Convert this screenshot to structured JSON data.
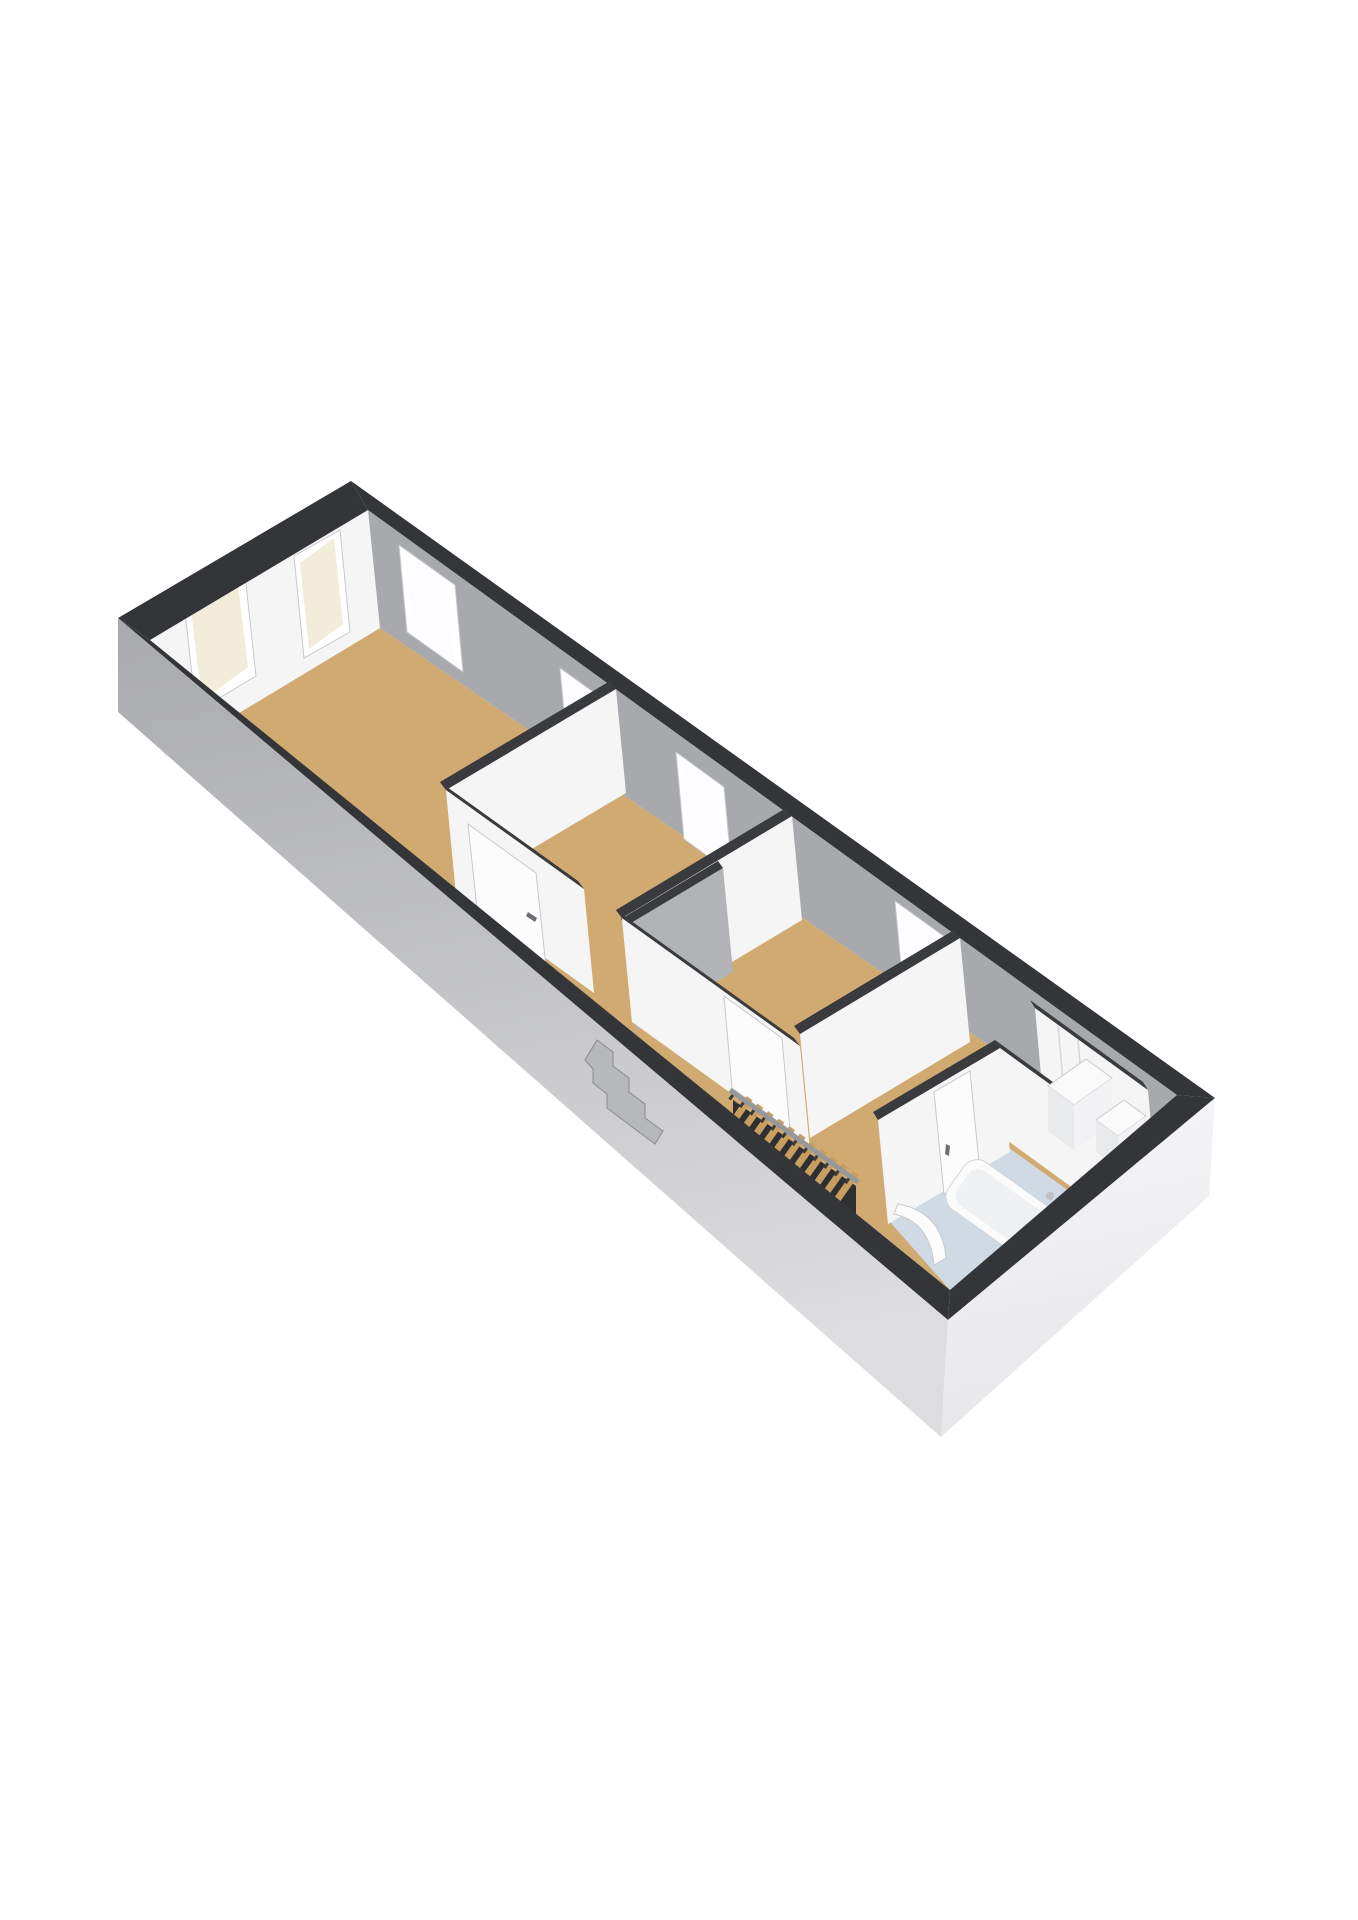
{
  "scene": {
    "kind": "3d-floor-plan",
    "view": "axonometric-top",
    "style": "floorplanner-render"
  },
  "inventory": {
    "rooms": [
      {
        "id": "bedroom-1",
        "floor": "wood",
        "windows": 4
      },
      {
        "id": "bedroom-2",
        "floor": "wood",
        "windows": 1
      },
      {
        "id": "bedroom-3",
        "floor": "wood",
        "windows": 1
      },
      {
        "id": "landing",
        "floor": "wood",
        "features": [
          "staircase",
          "balustrade"
        ]
      },
      {
        "id": "bathroom",
        "floor": "tile-blue",
        "features": [
          "bathtub",
          "door",
          "curved-screen"
        ]
      },
      {
        "id": "storage",
        "floor": "tile-light",
        "features": [
          "cabinet-large",
          "cabinet-small"
        ]
      }
    ],
    "doors": 4,
    "windows_total": 6
  },
  "colors": {
    "background": "#ffffff",
    "wall_top": "#343539",
    "wall_top_inner": "#3a3b3f",
    "wall_lit": "#f5f5f6",
    "wall_shadow": "#a8a9ad",
    "wall_mid": "#b2b3b7",
    "facade_sw_top": "#a9aaae",
    "facade_sw_bottom": "#dddddf",
    "facade_se_top": "#f6f6f8",
    "facade_se_bottom": "#e7e7e9",
    "floor_wood": "#d0aa70",
    "floor_bath": "#cfdae5",
    "floor_light": "#edeff1",
    "window_frame": "#ffffff",
    "frame_edge": "#c8c9cc",
    "glaze_cream": "#f2ecda",
    "glaze_bright": "#fdfdff",
    "stairs_wood": "#c79e5e",
    "stairs_base": "#2e2f32",
    "rail": "#97989c",
    "post": "#3a3b3e",
    "fixture_top": "#fafafb",
    "fixture_front": "#e9eaec",
    "fixture_side": "#f2f2f4",
    "tub_fill": "#fbfbfc",
    "tub_edge": "#d5d6d9",
    "tub_inner": "#eef0f2",
    "door_panel": "#fcfcfd",
    "handle": "#6e6f73",
    "faucet": "#c0c1c4",
    "protrusion": "#b7b8bc",
    "protrusion_edge": "#8a8b8f",
    "seam": "#d6d7d9"
  }
}
